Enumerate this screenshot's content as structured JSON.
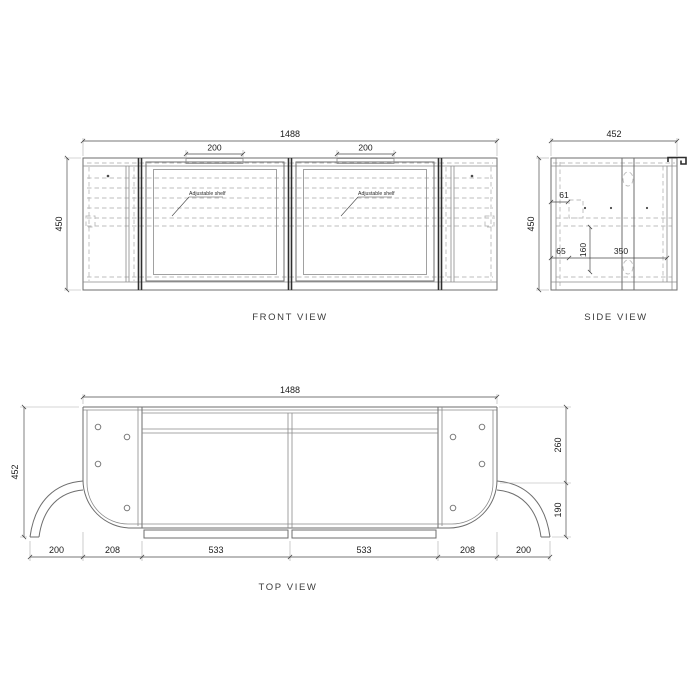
{
  "document": {
    "type": "technical-drawing",
    "subject": "wall-hung cabinet with curved side wings, three orthographic views"
  },
  "front": {
    "label": "FRONT VIEW",
    "dim_width": "1488",
    "dim_height": "450",
    "dim_handle_left": "200",
    "dim_handle_right": "200",
    "shelf_note_left": "Adjustable shelf",
    "shelf_note_right": "Adjustable shelf"
  },
  "side": {
    "label": "SIDE VIEW",
    "dim_width": "452",
    "dim_height": "450",
    "dim_top_rail": "61",
    "dim_bottom_rail": "65",
    "dim_shelf_gap": "160",
    "dim_interior_depth": "350"
  },
  "top": {
    "label": "TOP VIEW",
    "dim_width": "1488",
    "dim_depth": "452",
    "dim_right_back": "260",
    "dim_right_front": "190",
    "dim_bottom": [
      "200",
      "208",
      "533",
      "533",
      "208",
      "200"
    ]
  },
  "colors": {
    "background": "#ffffff",
    "object_line": "#6e6e6e",
    "heavy_line": "#2e2e2e",
    "hidden_line": "#bcbcbc",
    "dimension_line": "#4a4a4a",
    "text": "#1c1c1c"
  }
}
